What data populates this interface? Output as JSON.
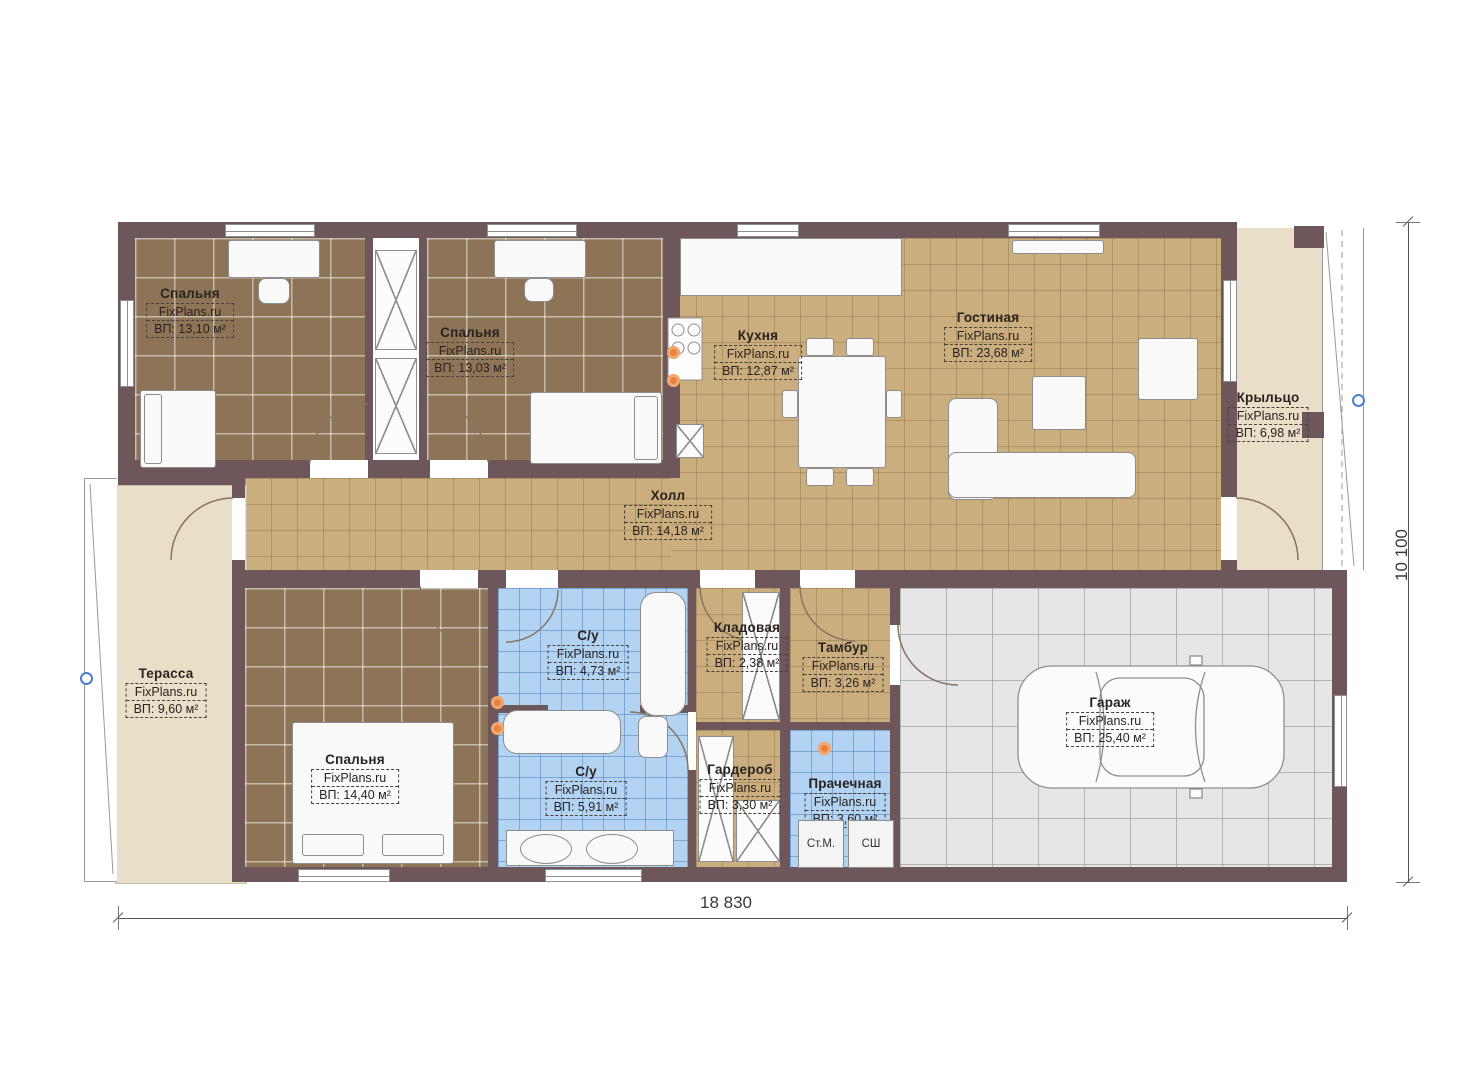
{
  "watermark": "FixPlans.ru",
  "rooms": [
    {
      "name": "Спальня",
      "area": "ВП: 13,10 м²"
    },
    {
      "name": "Спальня",
      "area": "ВП: 13,03 м²"
    },
    {
      "name": "Кухня",
      "area": "ВП: 12,87 м²"
    },
    {
      "name": "Гостиная",
      "area": "ВП: 23,68 м²"
    },
    {
      "name": "Крыльцо",
      "area": "ВП: 6,98 м²"
    },
    {
      "name": "Холл",
      "area": "ВП: 14,18 м²"
    },
    {
      "name": "Терасса",
      "area": "ВП: 9,60 м²"
    },
    {
      "name": "Спальня",
      "area": "ВП: 14,40 м²"
    },
    {
      "name": "С/у",
      "area": "ВП: 4,73 м²"
    },
    {
      "name": "Кладовая",
      "area": "ВП: 2,38 м²"
    },
    {
      "name": "Тамбур",
      "area": "ВП: 3,26 м²"
    },
    {
      "name": "С/у",
      "area": "ВП: 5,91 м²"
    },
    {
      "name": "Гардероб",
      "area": "ВП: 3,30 м²"
    },
    {
      "name": "Прачечная",
      "area": "ВП: 3,60 м²"
    },
    {
      "name": "Гараж",
      "area": "ВП: 25,40 м²"
    }
  ],
  "dimensions": {
    "width": "18 830",
    "height": "10 100"
  },
  "appliances": {
    "washer": "Ст.М.",
    "dryer": "СШ"
  },
  "colors": {
    "wall": "#6d575b",
    "floor_tile_brown": "#8d7457",
    "floor_tan": "#cbae7d",
    "floor_blue": "#b2d3f2",
    "floor_beige": "#e9dfc8",
    "floor_garage": "#e6e6e8",
    "accent_orange": "#e8823f",
    "marker_blue": "#4a7fd0"
  }
}
